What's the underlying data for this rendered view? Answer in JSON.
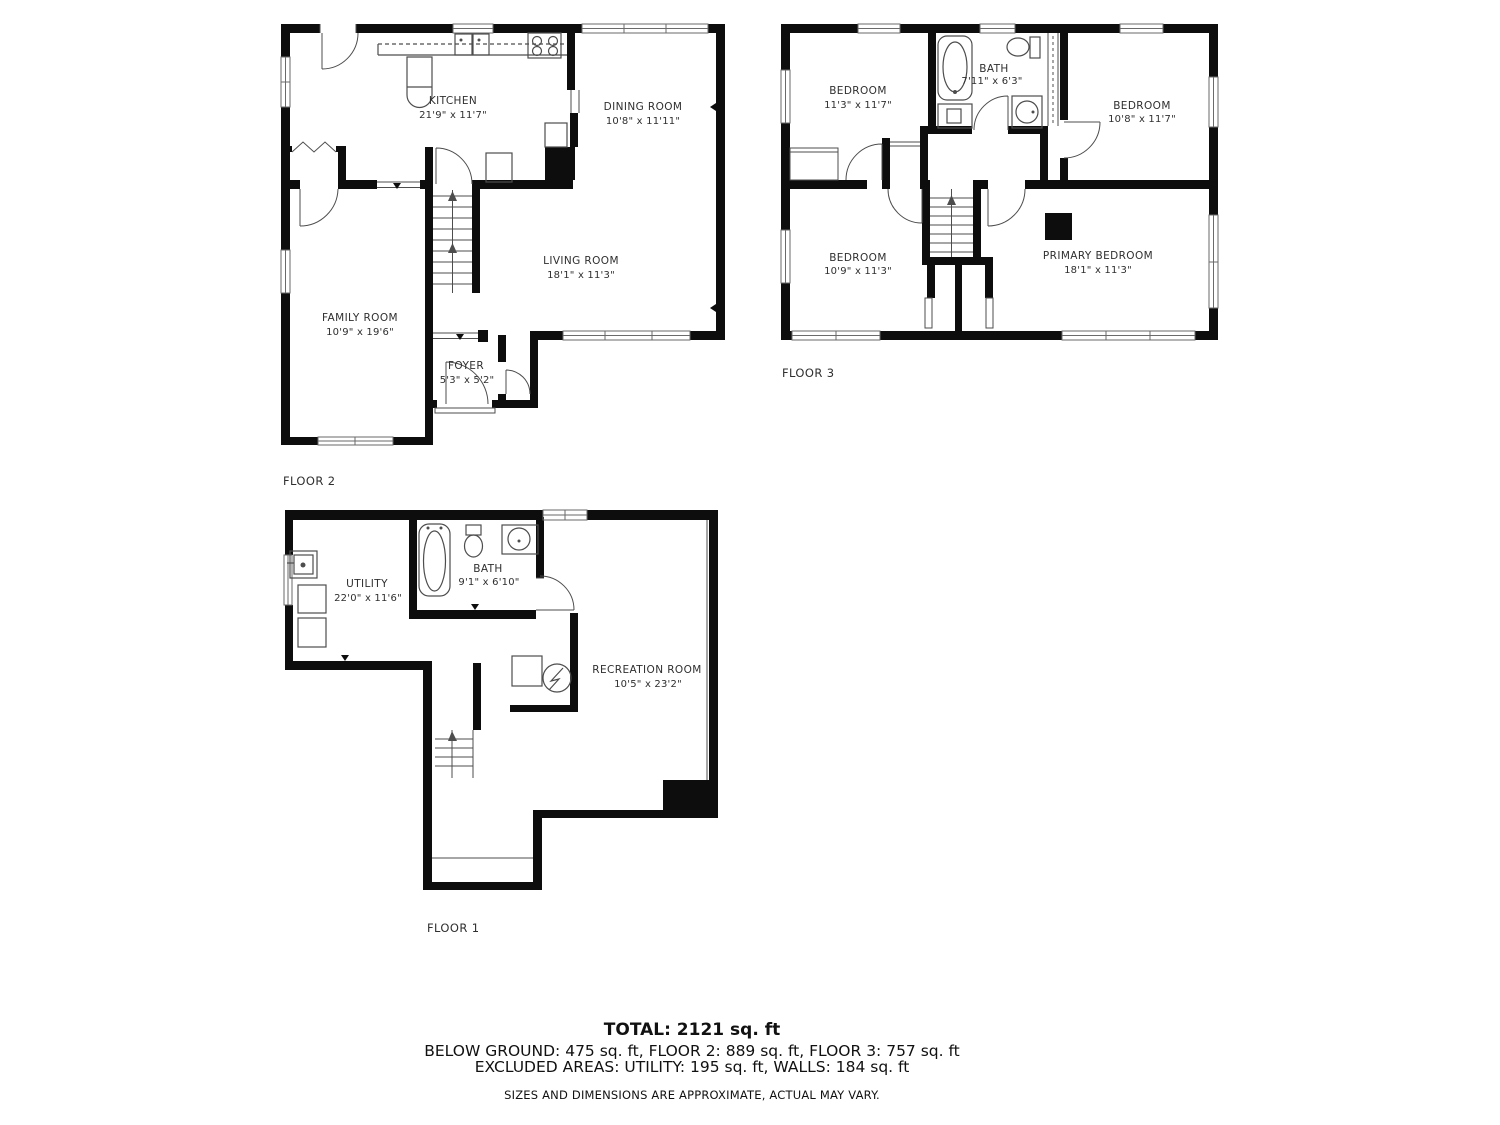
{
  "title": "Floor plan",
  "colors": {
    "background": "#ffffff",
    "wall": "#0d0d0d",
    "thin_line": "#4d4d4d",
    "label_text": "#2f2f2f",
    "summary_text": "#111111"
  },
  "floors": [
    {
      "label": "FLOOR 2",
      "rooms": [
        {
          "name": "KITCHEN",
          "dims": "21'9\" x 11'7\""
        },
        {
          "name": "DINING ROOM",
          "dims": "10'8\" x 11'11\""
        },
        {
          "name": "LIVING ROOM",
          "dims": "18'1\" x 11'3\""
        },
        {
          "name": "FAMILY ROOM",
          "dims": "10'9\" x 19'6\""
        },
        {
          "name": "FOYER",
          "dims": "5'3\" x 5'2\""
        }
      ]
    },
    {
      "label": "FLOOR 3",
      "rooms": [
        {
          "name": "BEDROOM",
          "dims": "11'3\" x 11'7\""
        },
        {
          "name": "BATH",
          "dims": "7'11\" x 6'3\""
        },
        {
          "name": "BEDROOM",
          "dims": "10'8\" x 11'7\""
        },
        {
          "name": "BEDROOM",
          "dims": "10'9\" x 11'3\""
        },
        {
          "name": "PRIMARY BEDROOM",
          "dims": "18'1\" x 11'3\""
        }
      ]
    },
    {
      "label": "FLOOR 1",
      "rooms": [
        {
          "name": "UTILITY",
          "dims": "22'0\" x 11'6\""
        },
        {
          "name": "BATH",
          "dims": "9'1\" x 6'10\""
        },
        {
          "name": "RECREATION ROOM",
          "dims": "10'5\" x 23'2\""
        }
      ]
    }
  ],
  "summary": {
    "total": "TOTAL: 2121 sq. ft",
    "line1": "BELOW GROUND: 475 sq. ft, FLOOR 2: 889 sq. ft, FLOOR 3: 757 sq. ft",
    "line2": "EXCLUDED AREAS: UTILITY: 195 sq. ft, WALLS: 184 sq. ft",
    "disclaimer": "SIZES AND DIMENSIONS ARE APPROXIMATE, ACTUAL MAY VARY."
  }
}
